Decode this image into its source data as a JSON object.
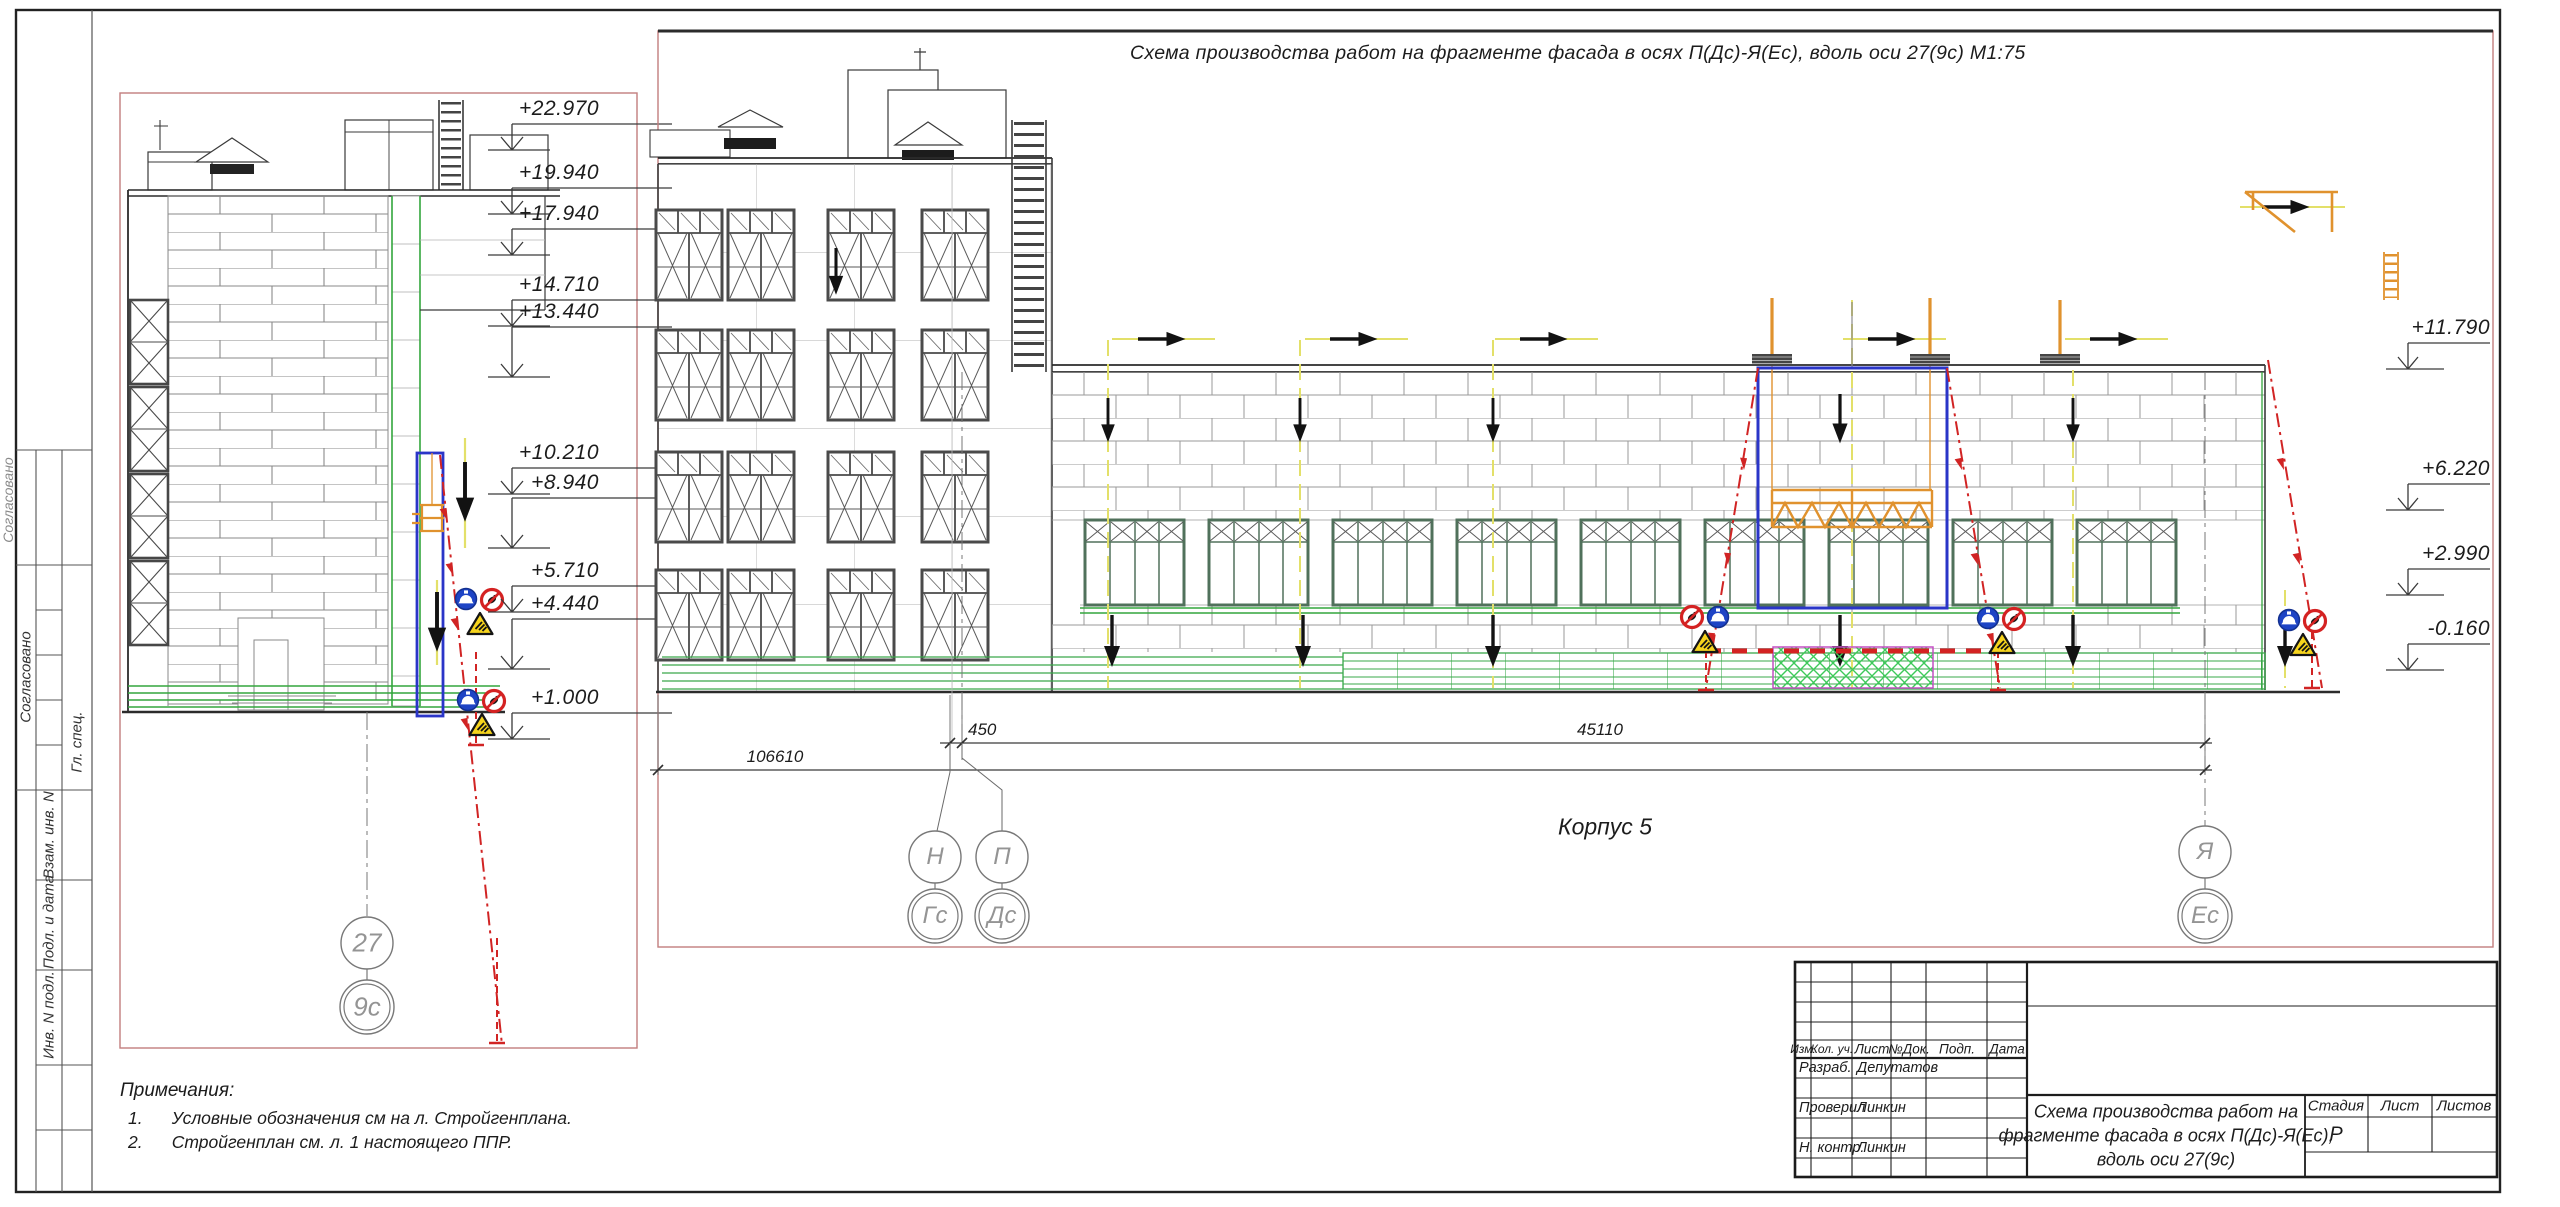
{
  "panel_main": {
    "title": "Схема производства работ на фрагменте фасада в осях П(Дс)-Я(Ес), вдоль оси 27(9с) М1:75",
    "building_label": "Корпус 5",
    "elevations_right": [
      "+11.790",
      "+6.220",
      "+2.990",
      "-0.160"
    ],
    "axes": {
      "n": "Н",
      "p": "П",
      "ya": "Я",
      "gs": "Гс",
      "ds": "Дс",
      "es": "Ес"
    },
    "dimensions": {
      "d450": "450",
      "d45110": "45110",
      "d106610": "106610"
    }
  },
  "panel_fragment": {
    "elevations": [
      "+22.970",
      "+19.940",
      "+17.940",
      "+14.710",
      "+13.440",
      "+10.210",
      "+8.940",
      "+5.710",
      "+4.440",
      "+1.000"
    ],
    "axis_top": "27",
    "axis_bottom": "9с"
  },
  "notes": {
    "heading": "Примечания:",
    "item1": "1.      Условные обозначения см на л. Стройгенплана.",
    "item2": "2.      Стройгенплан см. л. 1 настоящего ППР."
  },
  "side_column": {
    "approved_outer": "Согласовано",
    "approved": "Согласовано",
    "chief": "Гл. спец.",
    "replace_inv": "Взам. инв. N",
    "sign_date": "Подл. и дата",
    "inv_orig": "Инв. N подл."
  },
  "title_block": {
    "col_izm": "Изм.",
    "col_kol": "Кол. уч.",
    "col_list": "Лист",
    "col_ndok": "№Док.",
    "col_podp": "Подп.",
    "col_data": "Дата",
    "row1_role": "Разраб.",
    "row1_name": "Депутатов",
    "row2_role": "Проверил",
    "row2_name": "Линкин",
    "row3_role": "Н. контр.",
    "row3_name": "Линкин",
    "doc_title_l1": "Схема производства работ на",
    "doc_title_l2": "фрагменте фасада в осях П(Дс)-Я(Ес),",
    "doc_title_l3": "вдоль оси 27(9с)",
    "stage_label": "Стадия",
    "sheet_label": "Лист",
    "sheets_label": "Листов",
    "stage_value": "Р"
  },
  "colors": {
    "accent_blue": "#2a35c8",
    "accent_orange": "#e0922e",
    "danger_red": "#d12424",
    "green": "#33a63d",
    "frame_pink": "#c27e7e"
  }
}
